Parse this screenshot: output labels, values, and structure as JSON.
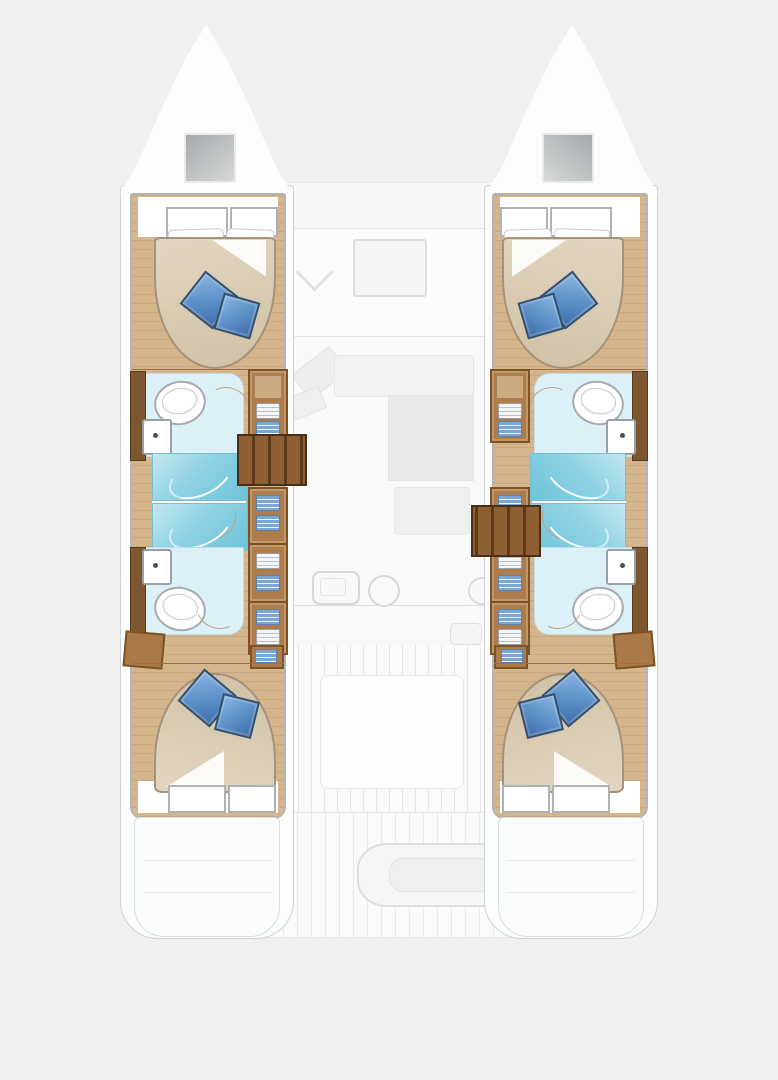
{
  "diagram": {
    "type": "yacht-floor-plan",
    "subject": "sailing catamaran deck and accommodation layout, bow up",
    "hull_count": 2,
    "cabins": 4,
    "bathrooms": 4,
    "center_spaces": [
      "forward cockpit",
      "saloon",
      "galley",
      "aft cockpit"
    ]
  },
  "labels": {
    "plan_title": "catamaran layout plan",
    "bow": "bow with deck hatch",
    "bow_hatch": "deck hatch",
    "forward_cabin": "forward double cabin",
    "forward_bathroom": "forward bathroom with toilet and washbasin",
    "shower": "shower stall",
    "aft_bathroom": "aft bathroom with toilet and washbasin",
    "aft_cabin": "aft double cabin",
    "wardrobe": "wardrobe with shelves",
    "stairs": "companionway steps",
    "fore_cockpit": "forward cockpit lounge",
    "saloon": "saloon with sofa, table and nav station",
    "galley": "galley with sink and stove",
    "aft_cockpit": "aft cockpit",
    "bench": "cockpit bench with table",
    "stern": "transom steps",
    "bed": "island double bed with blue pillows",
    "toilet": "toilet",
    "sink": "washbasin",
    "port_hull": "port hull",
    "starboard_hull": "starboard hull"
  },
  "palette": {
    "background": "#f0f0f0",
    "wood_floor": "#d4b58c",
    "wood_dark_trim": "#7d572f",
    "wardrobe_brown": "#ad7c4a",
    "stair_brown": "#8d5f33",
    "bed_linen_beige": "#d5c8af",
    "pillow_blue": "#5b8ec7",
    "shower_cyan": "#8ed2e4",
    "bathroom_floor_blue": "#dcf0f7",
    "fixture_white": "#ffffff",
    "faint_outline_gray": "#e2e4e6",
    "hatch_gray": "#b9bcbe"
  }
}
